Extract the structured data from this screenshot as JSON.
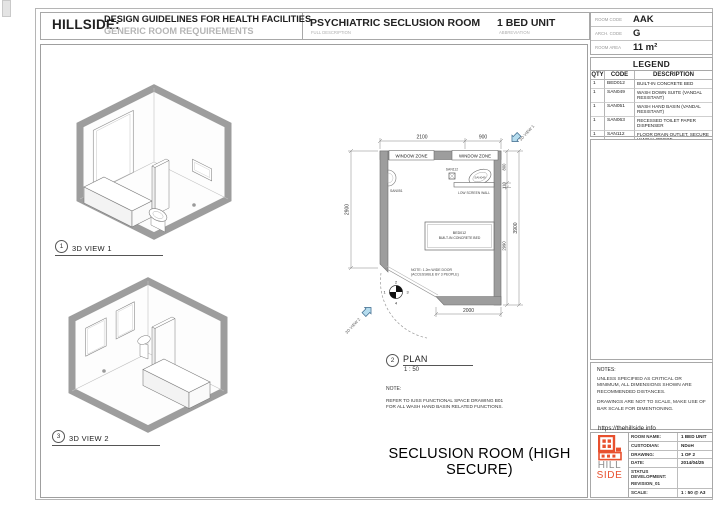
{
  "colors": {
    "wall_gray": "#9d9d9d",
    "logo_orange": "#e8502e",
    "arrow_blue": "#b5dcee"
  },
  "header": {
    "brand": "HILLSIDE:",
    "title_line1": "DESIGN GUIDELINES FOR HEALTH FACILITIES",
    "title_line2": "GENERIC ROOM REQUIREMENTS",
    "room_title": "PSYCHIATRIC SECLUSION ROOM",
    "room_title_caption": "FULL DESCRIPTION",
    "unit": "1 BED UNIT",
    "unit_caption": "ABBREVIATION",
    "room_code_label": "ROOM CODE",
    "room_code": "AAK",
    "arch_code_label": "ARCH. CODE",
    "arch_code": "G",
    "room_area_label": "ROOM AREA",
    "room_area": "11 m²"
  },
  "legend": {
    "title": "LEGEND",
    "columns": [
      "QTY",
      "CODE",
      "DESCRIPTION"
    ],
    "rows": [
      {
        "qty": "1",
        "code": "BED012",
        "description": "BUILT-IN CONCRETE BED"
      },
      {
        "qty": "1",
        "code": "SAN049",
        "description": "WASH DOWN SUITE (VANDAL RESISTANT)"
      },
      {
        "qty": "1",
        "code": "SAN051",
        "description": "WASH HAND BASIN (VANDAL RESISTANT)"
      },
      {
        "qty": "1",
        "code": "SAN063",
        "description": "RECESSED TOILET PAPER DISPENSER"
      },
      {
        "qty": "1",
        "code": "SAN112",
        "description": "FLOOR DRAIN OUTLET, SECURE VANDAL PROOF"
      }
    ]
  },
  "notes_panel": {
    "title": "NOTES:",
    "note1": "UNLESS SPECIFIED AS CRITICAL OR MINIMUM, ALL DIMENSIONS SHOWN ARE RECOMMENDED DISTANCES.",
    "note2": "DRAWINGS ARE NOT TO SCALE, MAKE USE OF BAR SCALE FOR DIMENTIONING.",
    "link": "https://thehillside.info",
    "bar_labels": [
      "0",
      "1m",
      "2m",
      "3m"
    ]
  },
  "title_block": {
    "logo_word1": "HILL",
    "logo_word2": "SIDE",
    "rows": [
      {
        "label": "ROOM NAME:",
        "value": "1 BED UNIT"
      },
      {
        "label": "CUSTODIAN:",
        "value": "NDoH"
      },
      {
        "label": "DRAWING:",
        "value": "1 OF 2"
      },
      {
        "label": "DATE:",
        "value": "2014/04/25"
      },
      {
        "label": "STATUS DEVELOPMENT:",
        "value": ""
      },
      {
        "label": "REVISION_01",
        "value": ""
      },
      {
        "label": "SCALE:",
        "value": "1 : 50 @ A3"
      }
    ]
  },
  "views": {
    "view1_num": "1",
    "view1_label": "3D VIEW 1",
    "view2_num": "3",
    "view2_label": "3D VIEW 2",
    "plan_num": "2",
    "plan_label": "PLAN",
    "plan_scale": "1 : 50"
  },
  "plan": {
    "window_zone": "WINDOW ZONE",
    "dim_top_left": "2100",
    "dim_top_right": "900",
    "dim_left": "2900",
    "dim_right_800": "800",
    "dim_right_110": "110",
    "dim_right_2990": "2990",
    "dim_right_total": "3900",
    "dim_bottom": "2000",
    "bed_code": "BED012",
    "bed_desc": "BUILT-IN CONCRETE BED",
    "san049": "SAN049",
    "san051": "SAN051",
    "san112": "SAN112",
    "low_screen_wall": "LOW SCREEN WALL",
    "door_note_1": "NOTE: 1.2m WIDE DOOR",
    "door_note_2": "(ACCESSIBLE BY 3 PEOPLE)",
    "view1_tag": "3D VIEW 1",
    "view2_tag": "3D VIEW 2",
    "compass": [
      "1",
      "2",
      "3",
      "4"
    ]
  },
  "footer": {
    "note_label": "NOTE:",
    "note_line1": "REFER TO IUSS FUNCTIONAL SPACE DRAWING B01",
    "note_line2": "FOR ALL WASH HAND BASIN RELATED FUNCTIONS.",
    "sheet_title": "SECLUSION ROOM (HIGH SECURE)"
  }
}
